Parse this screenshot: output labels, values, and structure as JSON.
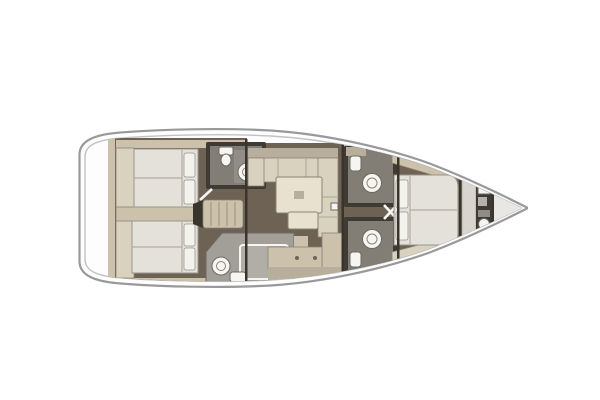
{
  "figure": {
    "type": "floor-plan",
    "subject": "sailing yacht interior layout, top view, bow pointing right",
    "view": "overhead deck plan"
  },
  "rooms": [
    "stern-platform",
    "aft-cabin-port",
    "aft-cabin-starboard",
    "aft-head-port",
    "aft-shower-room-starboard",
    "companionway-steps",
    "saloon",
    "saloon-table",
    "saloon-stool",
    "galley",
    "mid-head-port",
    "mid-head-starboard",
    "mast-step",
    "forward-cabin",
    "forward-head",
    "anchor-locker"
  ],
  "colors": {
    "background": "#ffffff",
    "hull_fill": "#fdfdfd",
    "hull_stroke": "#97999b",
    "inner_line": "#c1c2c3",
    "floor_dark": "#6e6255",
    "wall_dark": "#3a352c",
    "beige": "#ccc2ac",
    "beige_dark": "#b7ae9b",
    "beige_light": "#d9d2bf",
    "cream": "#e8e1cf",
    "mattress": "#e3e1da",
    "mattress_stroke": "#9a958a",
    "pillow": "#f3f2ef",
    "seam": "#b5aea0",
    "head_dark": "#3f3b34",
    "head_gray": "#837e75",
    "shower_gray": "#a29e98",
    "fixture_white": "#f6f5f2",
    "fixture_stroke": "#6c6962",
    "tread": "#b3aa94",
    "outline": "#8b8374",
    "forepeak": "#e9e7e3"
  }
}
